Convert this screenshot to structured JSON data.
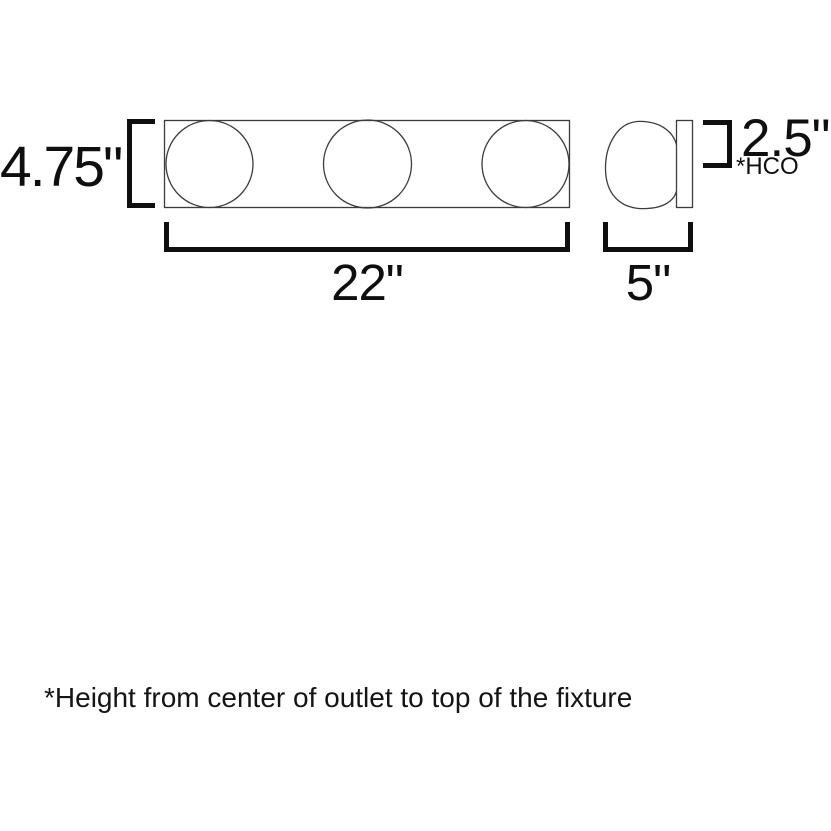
{
  "diagram": {
    "type": "product-dimension-drawing",
    "subject": "3-light bath vanity fixture",
    "front_view": {
      "height_label": "4.75\"",
      "width_label": "22\"",
      "globe_count": 3
    },
    "side_view": {
      "depth_label": "5\"",
      "hco_label": "2.5\"",
      "hco_abbr": "*HCO"
    },
    "footnote": "*Height from center of outlet to top of the fixture",
    "colors": {
      "background": "#ffffff",
      "fixture_outline": "#3c3c3c",
      "dimension_marks": "#0f0f0f"
    }
  }
}
